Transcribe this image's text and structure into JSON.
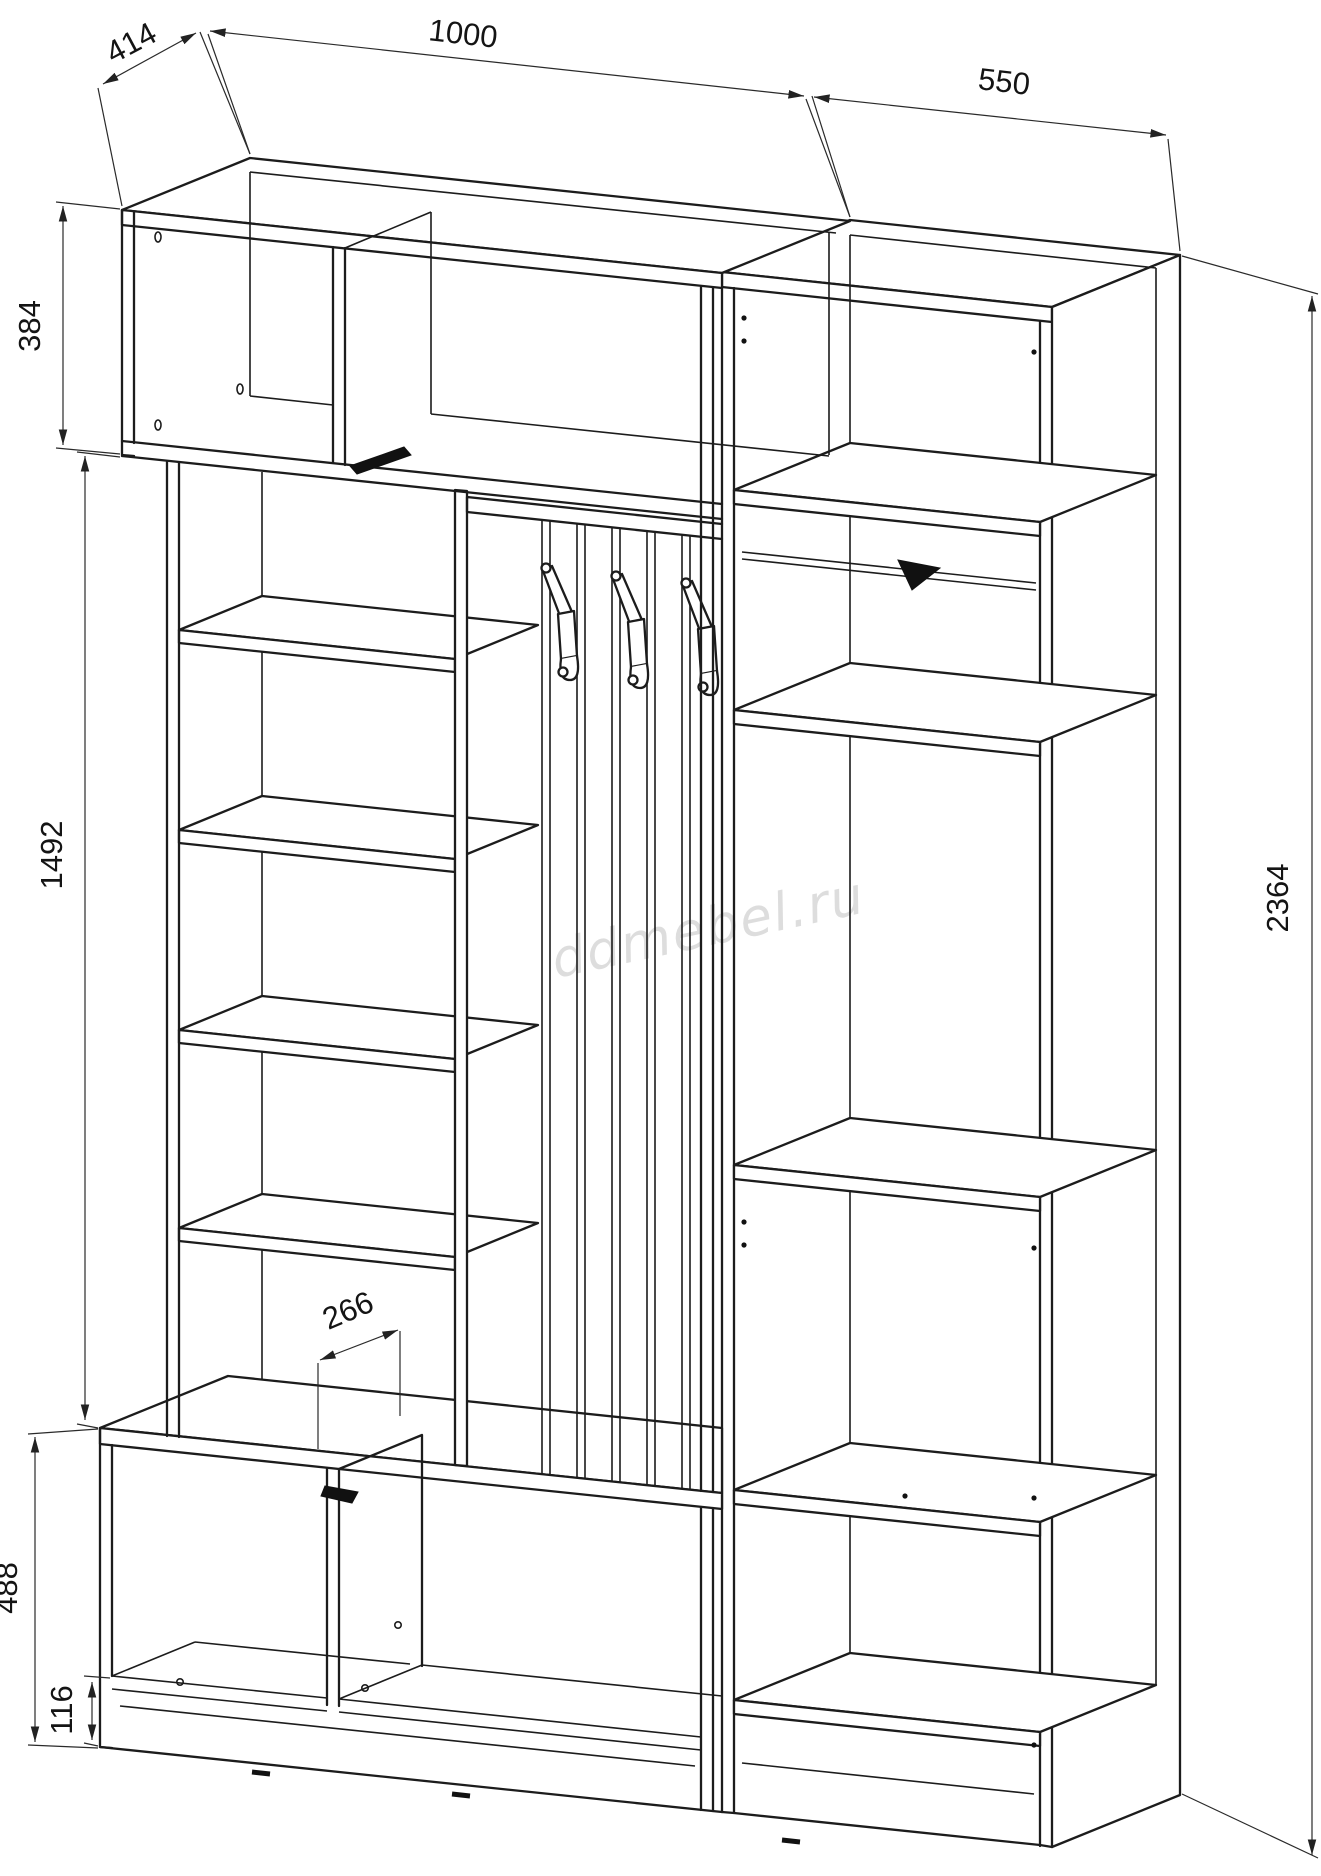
{
  "drawing_title": "wardrobe-hallway-unit-dimension-drawing",
  "dims": {
    "top_width": "1000",
    "depth": "414",
    "right_width": "550",
    "top_cabinet_height": "384",
    "open_middle_height": "1492",
    "total_height": "2364",
    "seat_depth": "266",
    "bench_height": "488",
    "base_height": "116"
  },
  "watermark": {
    "text": "ddmebel.ru"
  },
  "colors": {
    "line": "#1c1c1c",
    "dimension_line": "#2a2a2a",
    "watermark": "#dcdcdc",
    "background": "#ffffff"
  }
}
